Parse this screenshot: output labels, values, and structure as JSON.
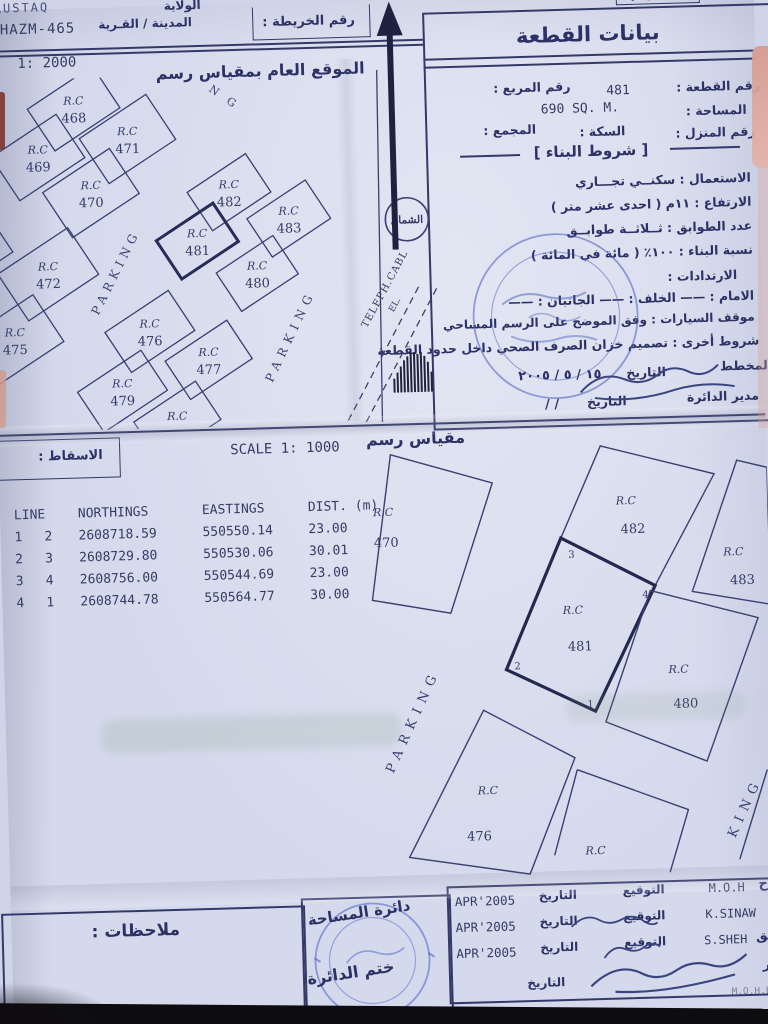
{
  "header": {
    "wilayat_label": "الولاية",
    "wilayat_value_partial": "RUSTAQ",
    "village_label": "المدينة / القـرية",
    "village_value": "LHAZM-465",
    "map_no_label": "رقم الخريطة :",
    "corner_partial": "رقم"
  },
  "upper_map": {
    "scale_value": "1: 2000",
    "title": "الموقع العام بمقياس رسم",
    "rc_label": "R.C",
    "plot_numbers": [
      "468",
      "469",
      "471",
      "470",
      "472",
      "475",
      "473",
      "482",
      "483",
      "481",
      "480",
      "476",
      "477",
      "479"
    ],
    "street_label": "PARKING",
    "street_partial": "N G",
    "north_label": "الشمال",
    "cable_label": "TELEPH.CABL",
    "cable_label2": "EL."
  },
  "plot_data": {
    "panel_title": "بيانات القطعة",
    "plot_no_label": "رقم القطعة :",
    "plot_no_value": "481",
    "square_no_label": "رقم المربع :",
    "area_label": "المساحة :",
    "area_value": "690 SQ. M.",
    "house_no_label": "رقم المنزل :",
    "street_label": "السكة :",
    "complex_label": "المجمع :",
    "building_terms_title": "[ شروط البناء ]",
    "usage_line": "الاستعمال : سكنــي تجـــاري",
    "height_line": "الارتفاع : ١١م ( احدى عشر متر )",
    "floors_line": "عدد الطوابق : ثــلاثــة طوابــق",
    "ratio_line": "نسبة البناء : ١٠٠٪ ( مائة في المائة )",
    "setbacks_label": "الارتدادات :",
    "setbacks_line": "الامام : ——    الخلف : ——    الجانبان : ——",
    "parking_line": "موقف السيارات : وفق الموضح على الرسم المساحي",
    "other_line": "شروط أخرى : تصميم خزان الصرف الصحي داخل حدود القطعة",
    "planner_label": "المخطط",
    "date_label": "التاريخ",
    "planner_date": "١٥ / ٥ / ٢٠٠٥",
    "director_label": "مدير الدائرة",
    "director_date": "/      /"
  },
  "scale_band": {
    "projection_label": "الاسقاط :",
    "scale_en": "SCALE 1:  1000",
    "scale_ar": "مقياس رسم"
  },
  "coords_table": {
    "headers": [
      "LINE",
      "NORTHINGS",
      "EASTINGS",
      "DIST. (m)"
    ],
    "rows": [
      [
        "1",
        "2",
        "2608718.59",
        "550550.14",
        "23.00"
      ],
      [
        "2",
        "3",
        "2608729.80",
        "550530.06",
        "30.01"
      ],
      [
        "3",
        "4",
        "2608756.00",
        "550544.69",
        "23.00"
      ],
      [
        "4",
        "1",
        "2608744.78",
        "550564.77",
        "30.00"
      ]
    ]
  },
  "lower_map": {
    "rc_label": "R.C",
    "plots": [
      "470",
      "482",
      "483",
      "481",
      "480",
      "476"
    ],
    "corners": [
      "1",
      "2",
      "3",
      "4"
    ],
    "street_label": "PARKING",
    "street_partial": "KING"
  },
  "footer": {
    "notes_label": "ملاحظات :",
    "stamp_line1": "دائرة المساحة",
    "stamp_line2": "ختم الدائرة",
    "sign_label": "التوقيع",
    "date_label": "التاريخ",
    "rows": [
      {
        "name": "M.O.H",
        "name_ar": "مساح",
        "date": "APR'2005"
      },
      {
        "name": "K.SINAW",
        "name_ar": "",
        "date": "APR'2005"
      },
      {
        "name": "S.SHEH",
        "name_ar": "تدقيق",
        "date": "APR'2005"
      },
      {
        "name": "",
        "name_ar": "مدير",
        "date": ""
      }
    ],
    "org_abbrev": "M.O.H.E.W"
  }
}
